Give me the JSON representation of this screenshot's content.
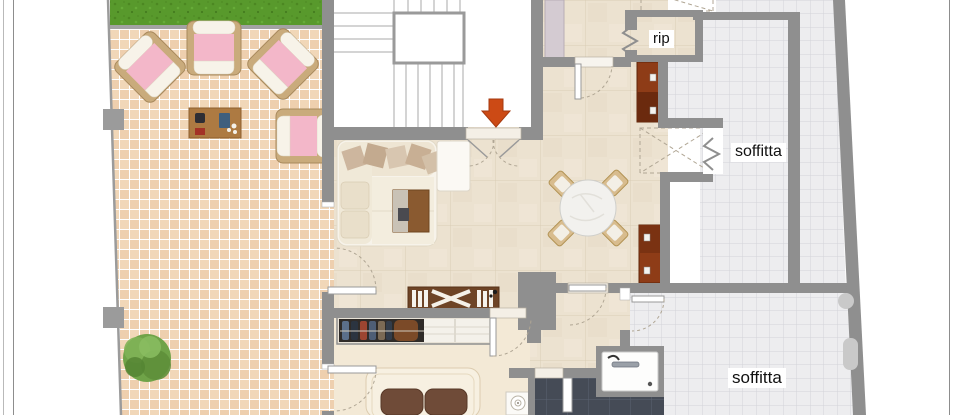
{
  "plan": {
    "type": "floor-plan",
    "labels": {
      "storage_room": "rip",
      "attic_upper": "soffitta",
      "attic_lower": "soffitta"
    },
    "colors": {
      "wall": "#8f8f8f",
      "entrance_arrow": "#cc4a15",
      "grass": "#58992c",
      "terrace_tile": "#f1d7b8",
      "grout": "#ffffff",
      "interior_tile": "#ece2d0",
      "attic_tile": "#ededef",
      "attic_grid": "#d2d3d9",
      "bathroom_tile": "#454b56",
      "bedroom_floor": "#f3e9d6",
      "cushion_pink": "#f3b7c9",
      "wood": "#c9ab7c",
      "cabinet_red": "#8e3c17",
      "door_arc": "#b0a694"
    }
  }
}
